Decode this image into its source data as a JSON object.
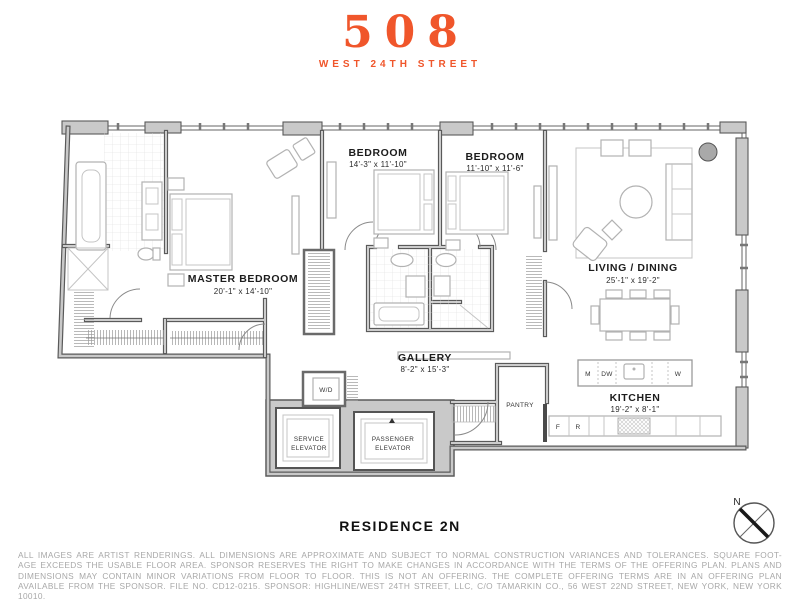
{
  "logo": {
    "number": "508",
    "street": "WEST 24TH STREET"
  },
  "title": "RESIDENCE 2N",
  "compass": {
    "north_label": "N"
  },
  "rooms": {
    "master_bedroom": {
      "name": "MASTER BEDROOM",
      "dims": "20'-1\" x 14'-10\""
    },
    "bedroom_1": {
      "name": "BEDROOM",
      "dims": "14'-3\" x 11'-10\""
    },
    "bedroom_2": {
      "name": "BEDROOM",
      "dims": "11'-10\" x 11'-6\""
    },
    "living_dining": {
      "name": "LIVING / DINING",
      "dims": "25'-1\" x 19'-2\""
    },
    "gallery": {
      "name": "GALLERY",
      "dims": "8'-2\" x 15'-3\""
    },
    "kitchen": {
      "name": "KITCHEN",
      "dims": "19'-2\" x 8'-1\""
    },
    "pantry": {
      "name": "PANTRY"
    },
    "service_elevator": {
      "line1": "SERVICE",
      "line2": "ELEVATOR"
    },
    "passenger_elevator": {
      "line1": "PASSENGER",
      "line2": "ELEVATOR"
    }
  },
  "appliances": {
    "washer_dryer": "W/D",
    "microwave": "M",
    "dishwasher": "DW",
    "wine_cooler": "W",
    "freezer": "F",
    "refrigerator": "R"
  },
  "disclaimer": {
    "line1": "ALL IMAGES ARE ARTIST RENDERINGS. ALL DIMENSIONS ARE APPROXIMATE AND SUBJECT TO NORMAL CONSTRUCTION VARIANCES AND TOLERANCES. SQUARE FOOT-",
    "line2": "AGE EXCEEDS THE USABLE FLOOR AREA. SPONSOR RESERVES THE RIGHT TO MAKE CHANGES IN ACCORDANCE WITH THE TERMS OF THE OFFERING PLAN. PLANS AND",
    "line3": "DIMENSIONS MAY CONTAIN MINOR VARIATIONS FROM FLOOR TO FLOOR. THIS IS NOT AN OFFERING. THE COMPLETE OFFERING TERMS ARE IN AN OFFERING PLAN",
    "line4": "AVAILABLE FROM THE SPONSOR. FILE NO. CD12-0215. SPONSOR: HIGHLINE/WEST 24TH STREET, LLC, C/O TAMARKIN CO., 56 WEST 22ND STREET, NEW YORK, NEW YORK 10010."
  },
  "colors": {
    "accent_orange": "#F0562B",
    "wall_edge": "#5A5A5A",
    "wall_fill": "#C9C9C9",
    "furniture": "#B2B2B2",
    "disclaimer_text": "#A8A8A8"
  }
}
